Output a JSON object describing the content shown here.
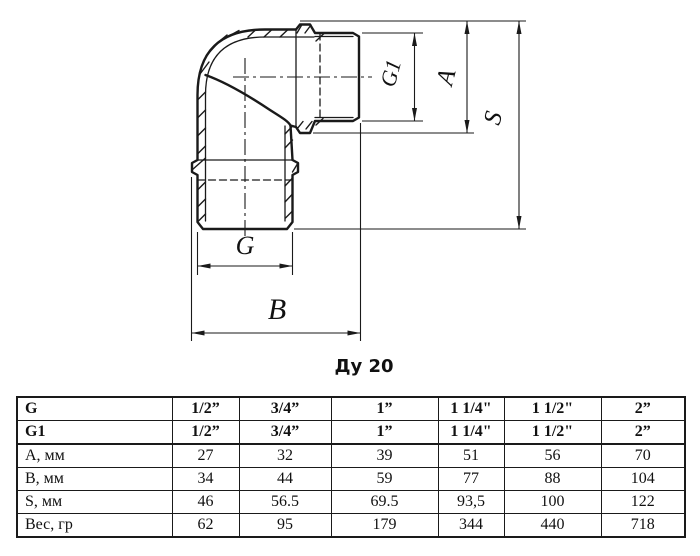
{
  "drawing": {
    "caption": "Ду 20",
    "dim_labels": {
      "g1": "G1",
      "a": "A",
      "s": "S",
      "g": "G",
      "b": "B"
    }
  },
  "table": {
    "rows": [
      {
        "label": "G",
        "bold": true,
        "values": [
          "1/2”",
          "3/4”",
          "1”",
          "1 1/4\"",
          "1 1/2\"",
          "2”"
        ]
      },
      {
        "label": "G1",
        "bold": true,
        "values": [
          "1/2”",
          "3/4”",
          "1”",
          "1 1/4\"",
          "1 1/2\"",
          "2”"
        ]
      },
      {
        "label": "А, мм",
        "bold": false,
        "values": [
          "27",
          "32",
          "39",
          "51",
          "56",
          "70"
        ]
      },
      {
        "label": "В, мм",
        "bold": false,
        "values": [
          "34",
          "44",
          "59",
          "77",
          "88",
          "104"
        ]
      },
      {
        "label": "S, мм",
        "bold": false,
        "values": [
          "46",
          "56.5",
          "69.5",
          "93,5",
          "100",
          "122"
        ]
      },
      {
        "label": "Вес, гр",
        "bold": false,
        "values": [
          "62",
          "95",
          "179",
          "344",
          "440",
          "718"
        ]
      }
    ]
  },
  "colors": {
    "line": "#1a1a1a",
    "background": "#ffffff"
  }
}
